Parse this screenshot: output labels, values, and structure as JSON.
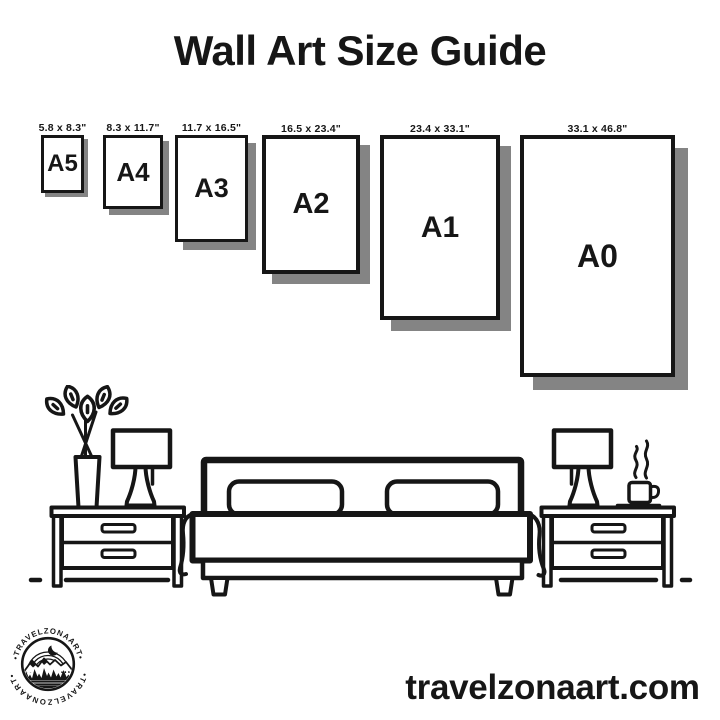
{
  "page": {
    "title": "Wall Art Size Guide",
    "website": "travelzonaart.com"
  },
  "colors": {
    "ink": "#161616",
    "shadow": "#848484",
    "background": "#ffffff"
  },
  "size_guide": {
    "items": [
      {
        "name": "A5",
        "dimensions": "5.8 x 8.3\"",
        "left": 41,
        "top": 135,
        "width": 43,
        "height": 58,
        "border": 3,
        "shadow": 4,
        "font": 24
      },
      {
        "name": "A4",
        "dimensions": "8.3 x 11.7\"",
        "left": 103,
        "top": 135,
        "width": 60,
        "height": 74,
        "border": 3,
        "shadow": 6,
        "font": 26
      },
      {
        "name": "A3",
        "dimensions": "11.7 x 16.5\"",
        "left": 175,
        "top": 135,
        "width": 73,
        "height": 107,
        "border": 3.5,
        "shadow": 8,
        "font": 27
      },
      {
        "name": "A2",
        "dimensions": "16.5 x 23.4\"",
        "left": 262,
        "top": 135,
        "width": 98,
        "height": 139,
        "border": 4,
        "shadow": 10,
        "font": 29
      },
      {
        "name": "A1",
        "dimensions": "23.4 x 33.1\"",
        "left": 380,
        "top": 135,
        "width": 120,
        "height": 185,
        "border": 4,
        "shadow": 11,
        "font": 30
      },
      {
        "name": "A0",
        "dimensions": "33.1 x 46.8\"",
        "left": 520,
        "top": 135,
        "width": 155,
        "height": 242,
        "border": 4.5,
        "shadow": 13,
        "font": 32
      }
    ]
  },
  "logo": {
    "arc_text_top": "•TRAVELZONAART•",
    "arc_text_bottom": "•TRAVELZONAART•"
  }
}
